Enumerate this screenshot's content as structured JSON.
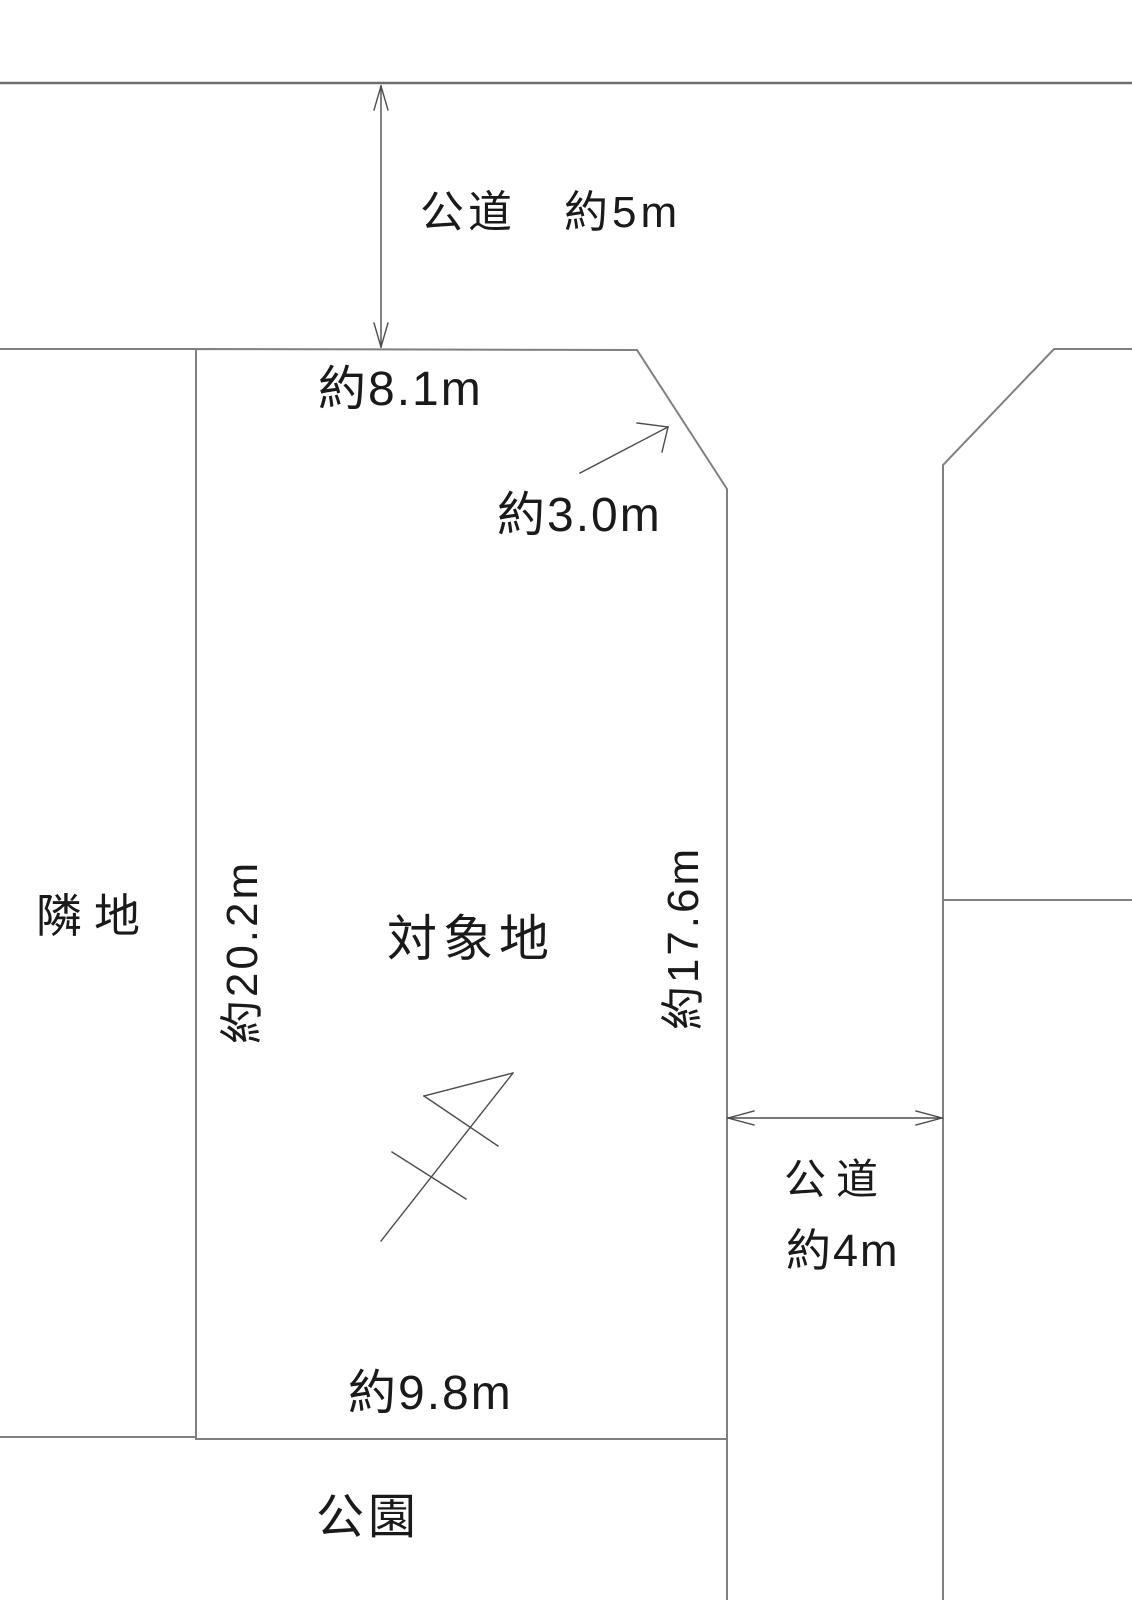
{
  "colors": {
    "background": "#ffffff",
    "boundary_line": "#808080",
    "arrow_line": "#4d4d4d",
    "text": "#1a1a1a"
  },
  "diagram": {
    "top_road": {
      "label": "公道　約5m"
    },
    "subject_plot": {
      "label": "対象地",
      "dimensions": {
        "top": "約8.1m",
        "corner_chamfer": "約3.0m",
        "left": "約20.2m",
        "right": "約17.6m",
        "bottom": "約9.8m"
      }
    },
    "neighbor": {
      "label": "隣地"
    },
    "right_road": {
      "name": "公道",
      "width": "約4m"
    },
    "park": {
      "label": "公園"
    }
  }
}
